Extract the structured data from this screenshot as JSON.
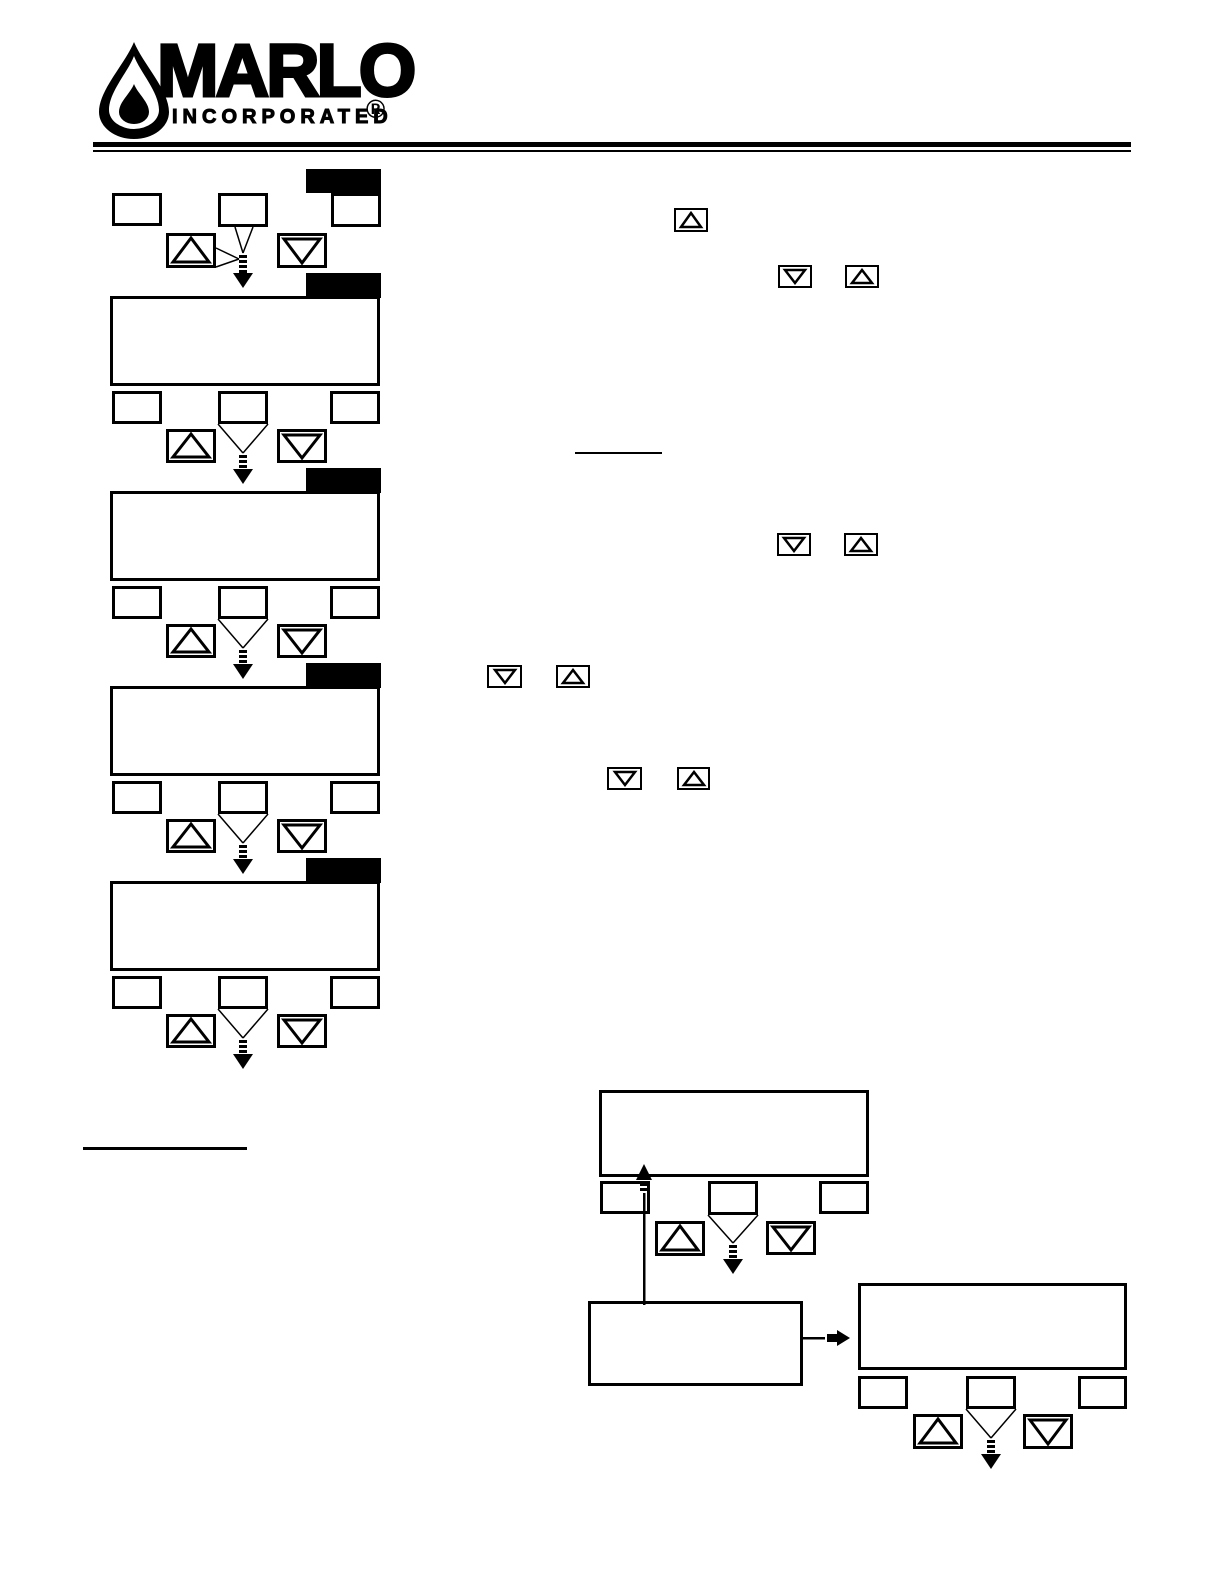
{
  "page": {
    "background": "#ffffff",
    "ink": "#000000"
  },
  "logo": {
    "brand": "MARLO",
    "subtitle": "INCORPORATED",
    "registered_mark": "®",
    "mark": "water-drop-icon"
  },
  "icons": {
    "up_key": "up-triangle",
    "down_key": "down-triangle",
    "flow_down": "dashed-down-arrow",
    "flow_up": "dashed-up-arrow",
    "flow_right": "right-arrow"
  }
}
